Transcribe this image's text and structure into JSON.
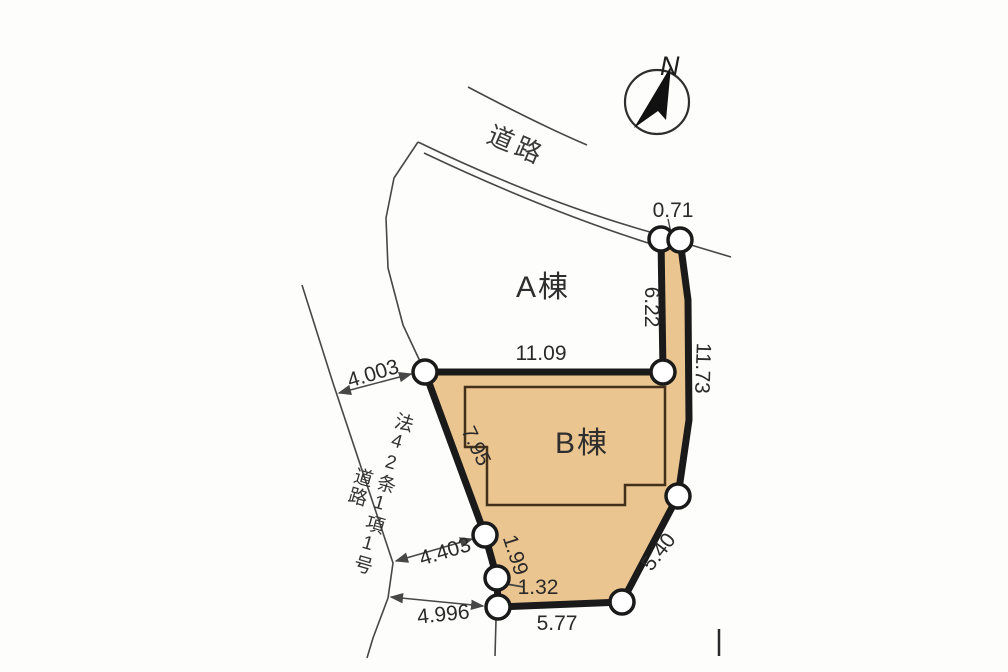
{
  "labels": {
    "north": "N",
    "road": "道路",
    "building_a": "A棟",
    "building_b": "B棟",
    "road_law_col_right": "法42条1項1号",
    "road_law_col_left": "道路"
  },
  "measurements": {
    "top_width": "0.71",
    "strip_left": "6.22",
    "east_side": "11.73",
    "north_side": "11.09",
    "road_width_north": "4.003",
    "west_side": "7.95",
    "southwest_upper": "1.99",
    "southwest_lower": "1.32",
    "road_width_middle": "4.403",
    "road_width_south": "4.996",
    "south_side": "5.77",
    "southeast_side": "5.40"
  },
  "colors": {
    "parcel_fill": "#ebc590",
    "boundary_line": "#1a1a1a",
    "thin_line": "#474747",
    "text": "#2a2a2a"
  }
}
